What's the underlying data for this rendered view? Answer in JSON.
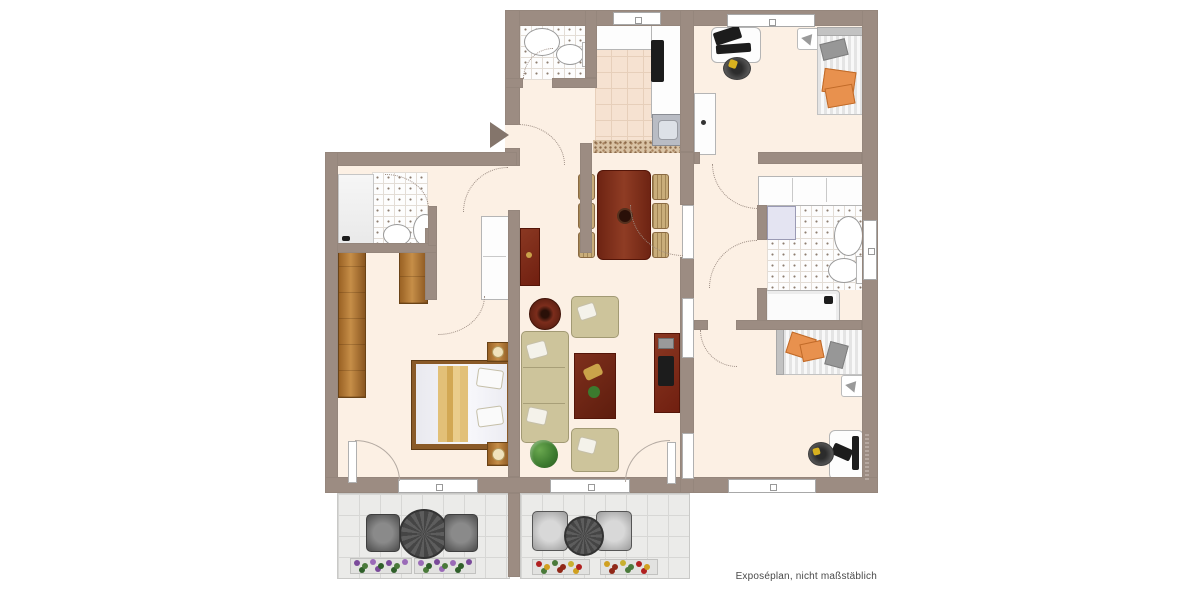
{
  "caption": {
    "text": "Exposéplan, nicht maßstäblich"
  },
  "colors": {
    "wall": "#9c8c82",
    "floor": "#fcf0e4",
    "bathtile": "#fdfdfd",
    "kitchenfloor": "#f6e2d1",
    "terrace": "#ebebe9",
    "orange": "#e8914e",
    "arc": "#9c8c82",
    "arrow": "#84756b",
    "wood": "#a9702f",
    "redwood": "#7c2d1c",
    "sofa": "#cdc49b"
  },
  "fixtures": {
    "entrance_arrow": "triangle-right",
    "guest_wc": [
      "sink",
      "toilet"
    ],
    "kitchen": [
      "counter",
      "cooktop",
      "sink-unit"
    ],
    "dining": [
      "table",
      "chairs-6"
    ],
    "bathroom_left": [
      "shower",
      "sink",
      "toilet"
    ],
    "bathroom_right": [
      "washing-machine",
      "sink",
      "toilet",
      "bathtub",
      "window"
    ],
    "bedroom_left": [
      "double-bed",
      "nightstands",
      "wardrobes",
      "balcony-door"
    ],
    "room_top_right": [
      "desk",
      "computer",
      "office-chair",
      "lamp",
      "single-bed",
      "cabinet"
    ],
    "room_bottom_right": [
      "single-bed",
      "lamp",
      "desk",
      "office-chair"
    ],
    "living_room": [
      "sofa",
      "armchairs-2",
      "coffee-table",
      "side-table",
      "sideboard-tv",
      "plant"
    ],
    "terrace_left": [
      "table",
      "chairs-2",
      "flower-boxes"
    ],
    "terrace_right": [
      "table",
      "chairs-2",
      "flower-boxes"
    ]
  }
}
